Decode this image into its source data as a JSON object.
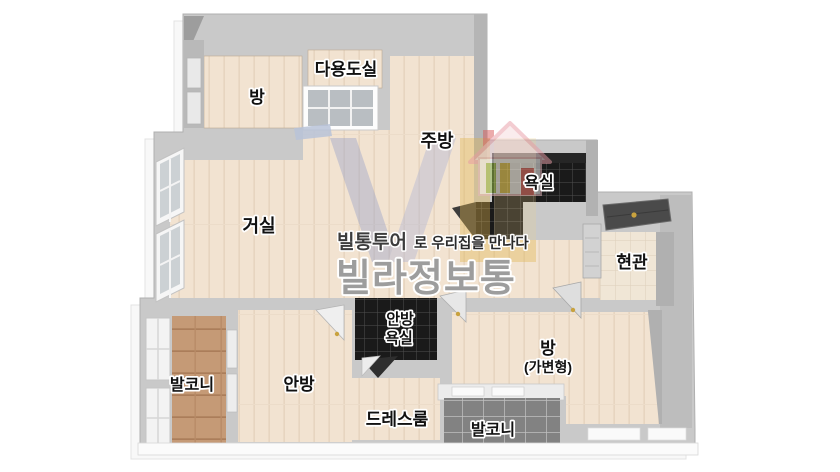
{
  "image_title": "apartment floor plan",
  "rooms": {
    "bedroom_top": "방",
    "utility": "다용도실",
    "kitchen": "주방",
    "bathroom": "욕실",
    "entrance": "현관",
    "living": "거실",
    "master_bath_line1": "안방",
    "master_bath_line2": "욕실",
    "flex_line1": "방",
    "flex_line2": "(가변형)",
    "balcony_left": "발코니",
    "master": "안방",
    "dressroom": "드레스룸",
    "balcony_bottom": "발코니"
  },
  "watermark": {
    "tagline_brand": "빌통투어",
    "tagline_rest": "로 우리집을 만나다",
    "brand": "빌라정보통"
  },
  "colors": {
    "floor_beige": "#f2e3d1",
    "wall_gray": "#c9c9c9",
    "balcony_wood": "#c59a76",
    "tile_black": "#1a1a1a",
    "tile_gray": "#828282",
    "entrance_tile": "#f0e6d6",
    "brand_gray": "#9d9d9d",
    "logo_blue": "#99a3cd",
    "logo_yellow": "#e0b44e",
    "house_pink": "#e89aa4",
    "door_dark": "#4a4a4a",
    "handle_gold": "#c9a23e"
  }
}
